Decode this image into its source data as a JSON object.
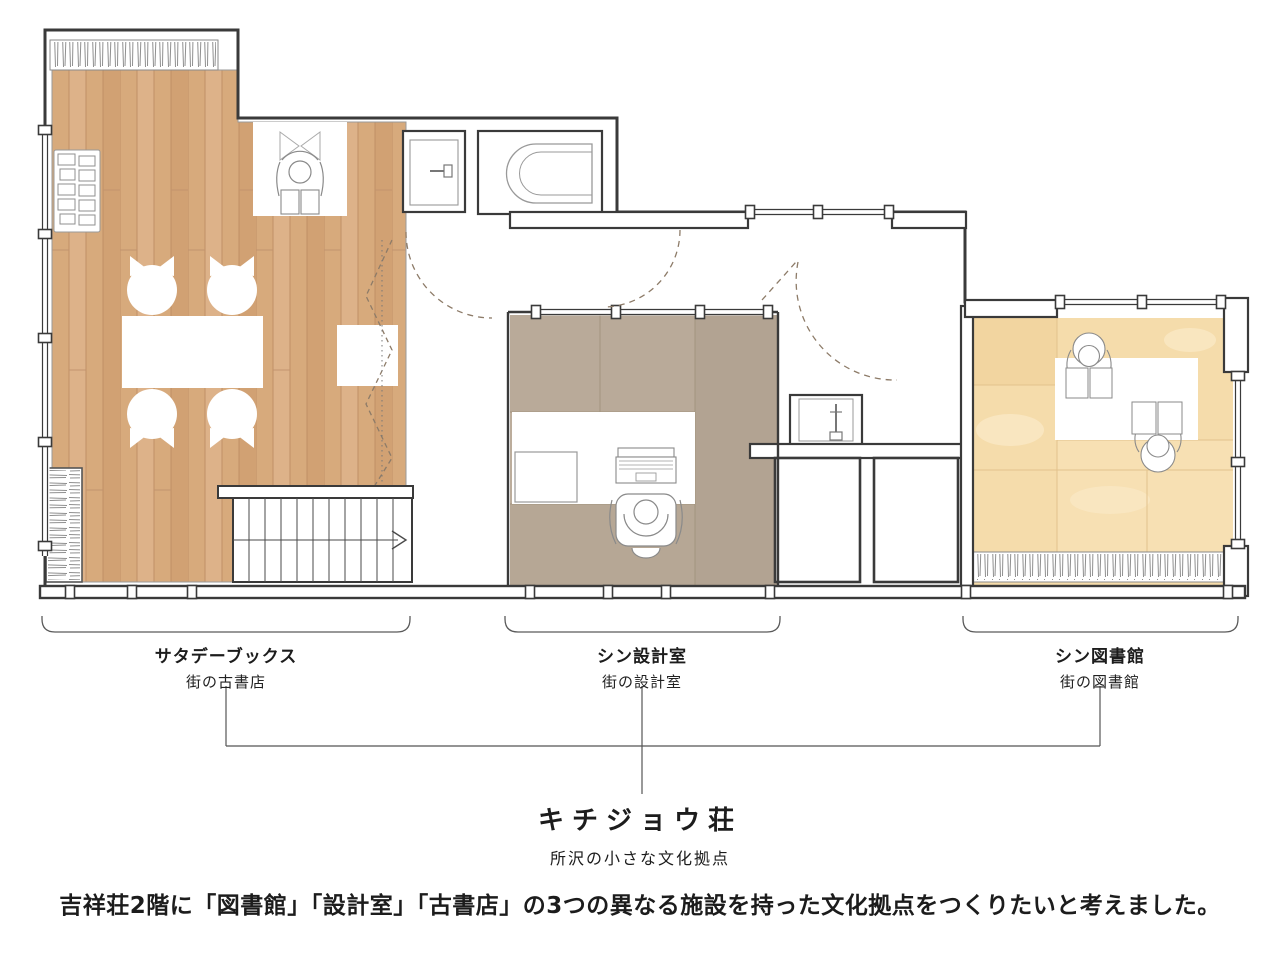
{
  "plan": {
    "areas": [
      {
        "name": "サタデーブックス",
        "subtitle": "街の古書店"
      },
      {
        "name": "シン設計室",
        "subtitle": "街の設計室"
      },
      {
        "name": "シン図書館",
        "subtitle": "街の図書館"
      }
    ],
    "building": {
      "title": "キチジョウ荘",
      "subtitle": "所沢の小さな文化拠点"
    }
  },
  "caption": "吉祥荘2階に「図書館」「設計室」「古書店」の3つの異なる施設を持った文化拠点をつくりたいと考えました。",
  "palette": {
    "wall": "#3a3a3a",
    "wood_floor": "#d7aa7c",
    "office_floor": "#bcad9c",
    "library_floor": "#f5dcab",
    "dashed_door": "#8d7b68"
  }
}
